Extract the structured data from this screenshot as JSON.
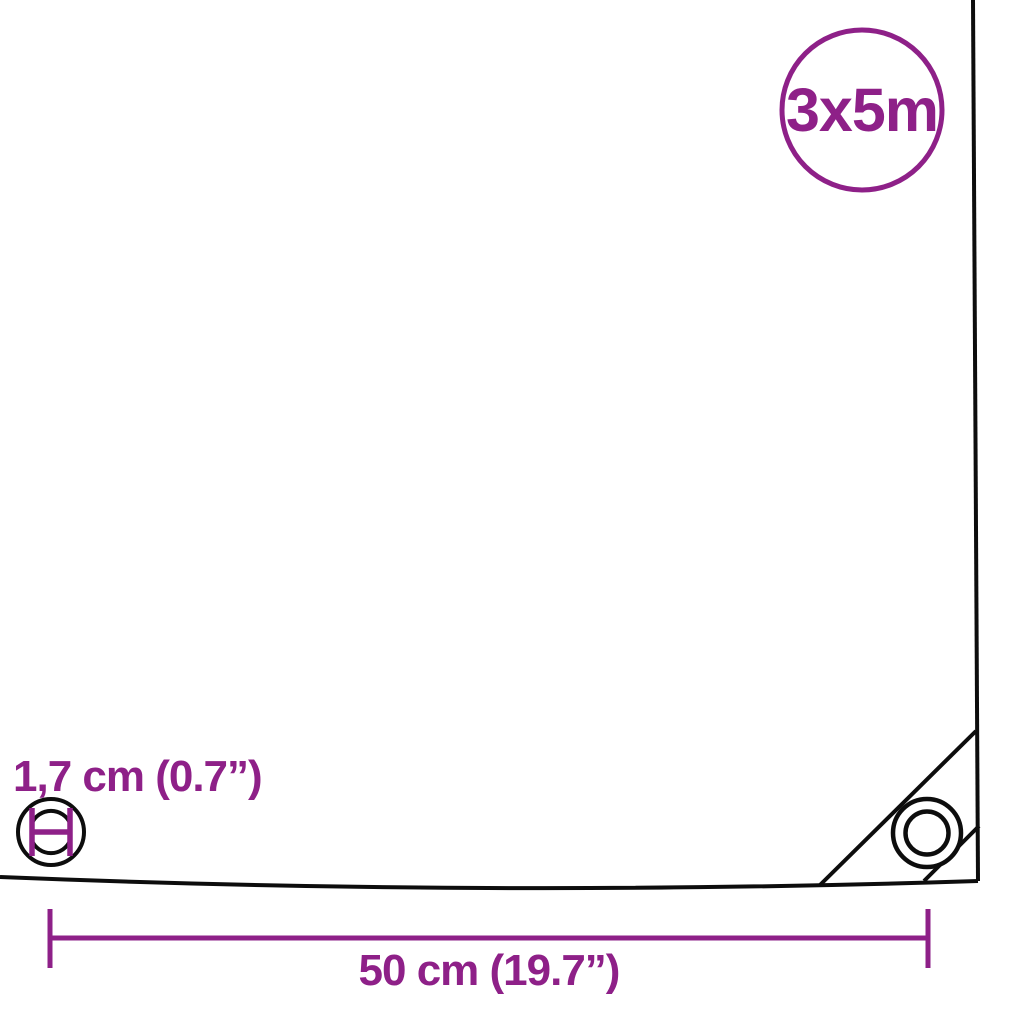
{
  "diagram": {
    "background_color": "#ffffff",
    "accent_color": "#8E2088",
    "line_color": "#0D0D0D",
    "size_badge": {
      "label": "3x5m"
    },
    "eyelet_detail": {
      "label": "1,7 cm (0.7”)"
    },
    "spacing_dimension": {
      "label": "50 cm (19.7”)"
    }
  }
}
